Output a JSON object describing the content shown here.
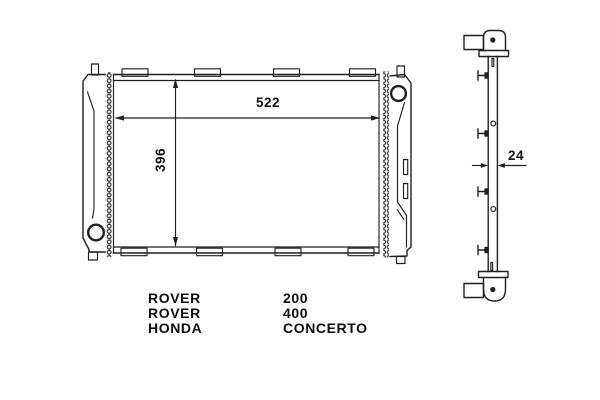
{
  "diagram_type": "radiator-technical-drawing",
  "colors": {
    "line": "#1f1f1f",
    "background": "#ffffff",
    "text": "#0d0d0d"
  },
  "front_view": {
    "name": "radiator front view",
    "core_width_mm": "522",
    "core_height_mm": "396"
  },
  "side_view": {
    "name": "radiator side profile",
    "depth_mm": "24"
  },
  "applications": [
    {
      "make": "ROVER",
      "model": "200"
    },
    {
      "make": "ROVER",
      "model": "400"
    },
    {
      "make": "HONDA",
      "model": "CONCERTO"
    }
  ]
}
